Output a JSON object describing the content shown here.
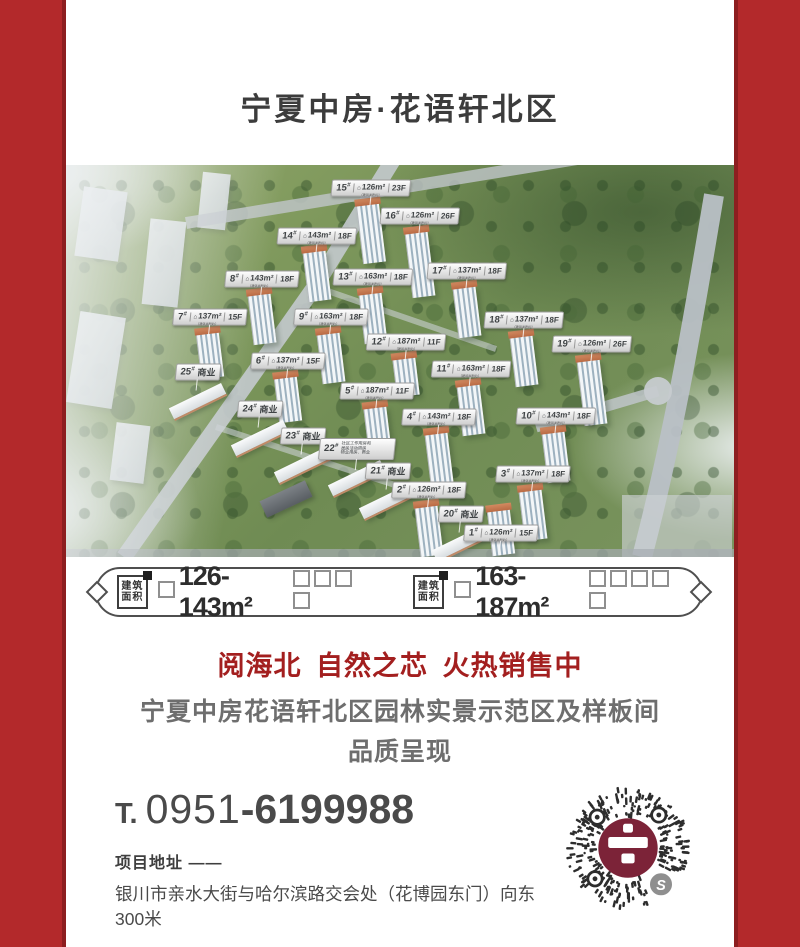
{
  "frame": {
    "border_color": "#b3292b",
    "inner_line_color": "#8d1e20"
  },
  "header": {
    "title": "宁夏中房·花语轩北区"
  },
  "aerial": {
    "chip_caption": "（建筑面积约）",
    "house_icon_glyph": "⌂",
    "buildings": [
      {
        "type": "res",
        "no": "15#",
        "area": "126m²",
        "floors": "23F",
        "x": 45.7,
        "y": 5.9
      },
      {
        "type": "res",
        "no": "16#",
        "area": "126m²",
        "floors": "26F",
        "x": 53.0,
        "y": 13.0
      },
      {
        "type": "res",
        "no": "14#",
        "area": "143m²",
        "floors": "18F",
        "x": 37.5,
        "y": 18.0
      },
      {
        "type": "res",
        "no": "8#",
        "area": "143m²",
        "floors": "18F",
        "x": 29.4,
        "y": 29.0
      },
      {
        "type": "res",
        "no": "13#",
        "area": "163m²",
        "floors": "18F",
        "x": 46.0,
        "y": 28.6
      },
      {
        "type": "res",
        "no": "17#",
        "area": "137m²",
        "floors": "18F",
        "x": 60.0,
        "y": 27.0
      },
      {
        "type": "res",
        "no": "7#",
        "area": "137m²",
        "floors": "15F",
        "x": 21.6,
        "y": 38.8
      },
      {
        "type": "res",
        "no": "9#",
        "area": "163m²",
        "floors": "18F",
        "x": 39.6,
        "y": 38.8
      },
      {
        "type": "res",
        "no": "18#",
        "area": "137m²",
        "floors": "18F",
        "x": 68.5,
        "y": 39.5
      },
      {
        "type": "res",
        "no": "19#",
        "area": "126m²",
        "floors": "26F",
        "x": 78.8,
        "y": 45.7
      },
      {
        "type": "res",
        "no": "12#",
        "area": "187m²",
        "floors": "11F",
        "x": 50.9,
        "y": 45.2
      },
      {
        "type": "res",
        "no": "6#",
        "area": "137m²",
        "floors": "15F",
        "x": 33.3,
        "y": 50.0
      },
      {
        "type": "res",
        "no": "11#",
        "area": "163m²",
        "floors": "18F",
        "x": 60.7,
        "y": 52.0
      },
      {
        "type": "res",
        "no": "5#",
        "area": "187m²",
        "floors": "11F",
        "x": 46.6,
        "y": 57.7
      },
      {
        "type": "res",
        "no": "4#",
        "area": "143m²",
        "floors": "18F",
        "x": 55.8,
        "y": 64.3
      },
      {
        "type": "res",
        "no": "10#",
        "area": "143m²",
        "floors": "18F",
        "x": 73.4,
        "y": 64.0
      },
      {
        "type": "res",
        "no": "3#",
        "area": "137m²",
        "floors": "18F",
        "x": 69.9,
        "y": 78.8
      },
      {
        "type": "res",
        "no": "2#",
        "area": "126m²",
        "floors": "18F",
        "x": 54.3,
        "y": 82.9
      },
      {
        "type": "res",
        "no": "1#",
        "area": "126m²",
        "floors": "15F",
        "x": 65.1,
        "y": 94.0
      },
      {
        "type": "biz",
        "no": "25#",
        "label": "商业",
        "x": 19.7,
        "y": 52.8
      },
      {
        "type": "biz",
        "no": "24#",
        "label": "商业",
        "x": 29.1,
        "y": 62.2
      },
      {
        "type": "biz",
        "no": "23#",
        "label": "商业",
        "x": 35.5,
        "y": 69.1
      },
      {
        "type": "mixed",
        "no": "22#",
        "lines": [
          "社区工作用房和",
          "居民活动用房",
          "物业用房、商业"
        ],
        "x": 43.6,
        "y": 72.4
      },
      {
        "type": "biz",
        "no": "21#",
        "label": "商业",
        "x": 48.2,
        "y": 78.1
      },
      {
        "type": "biz",
        "no": "20#",
        "label": "商业",
        "x": 59.1,
        "y": 89.0
      }
    ]
  },
  "specs": {
    "stamp_line1": "建筑",
    "stamp_line2": "面积",
    "group1": {
      "range": "126-143m²",
      "boxes_before": 1,
      "boxes_after": 4
    },
    "group2": {
      "range": "163-187m²",
      "boxes_before": 1,
      "boxes_after": 5
    }
  },
  "promo": {
    "headline": "阅海北 自然之芯 火热销售中",
    "line1": "宁夏中房花语轩北区园林实景示范区及样板间",
    "line2": "品质呈现"
  },
  "contact": {
    "phone_label": "T.",
    "phone_area": "0951",
    "phone_number": "-6199988",
    "address_label": "项目地址 ——",
    "address": "银川市亲水大街与哈尔滨路交会处（花博园东门）向东300米"
  },
  "qr": {
    "mini_program_badge": "S"
  }
}
